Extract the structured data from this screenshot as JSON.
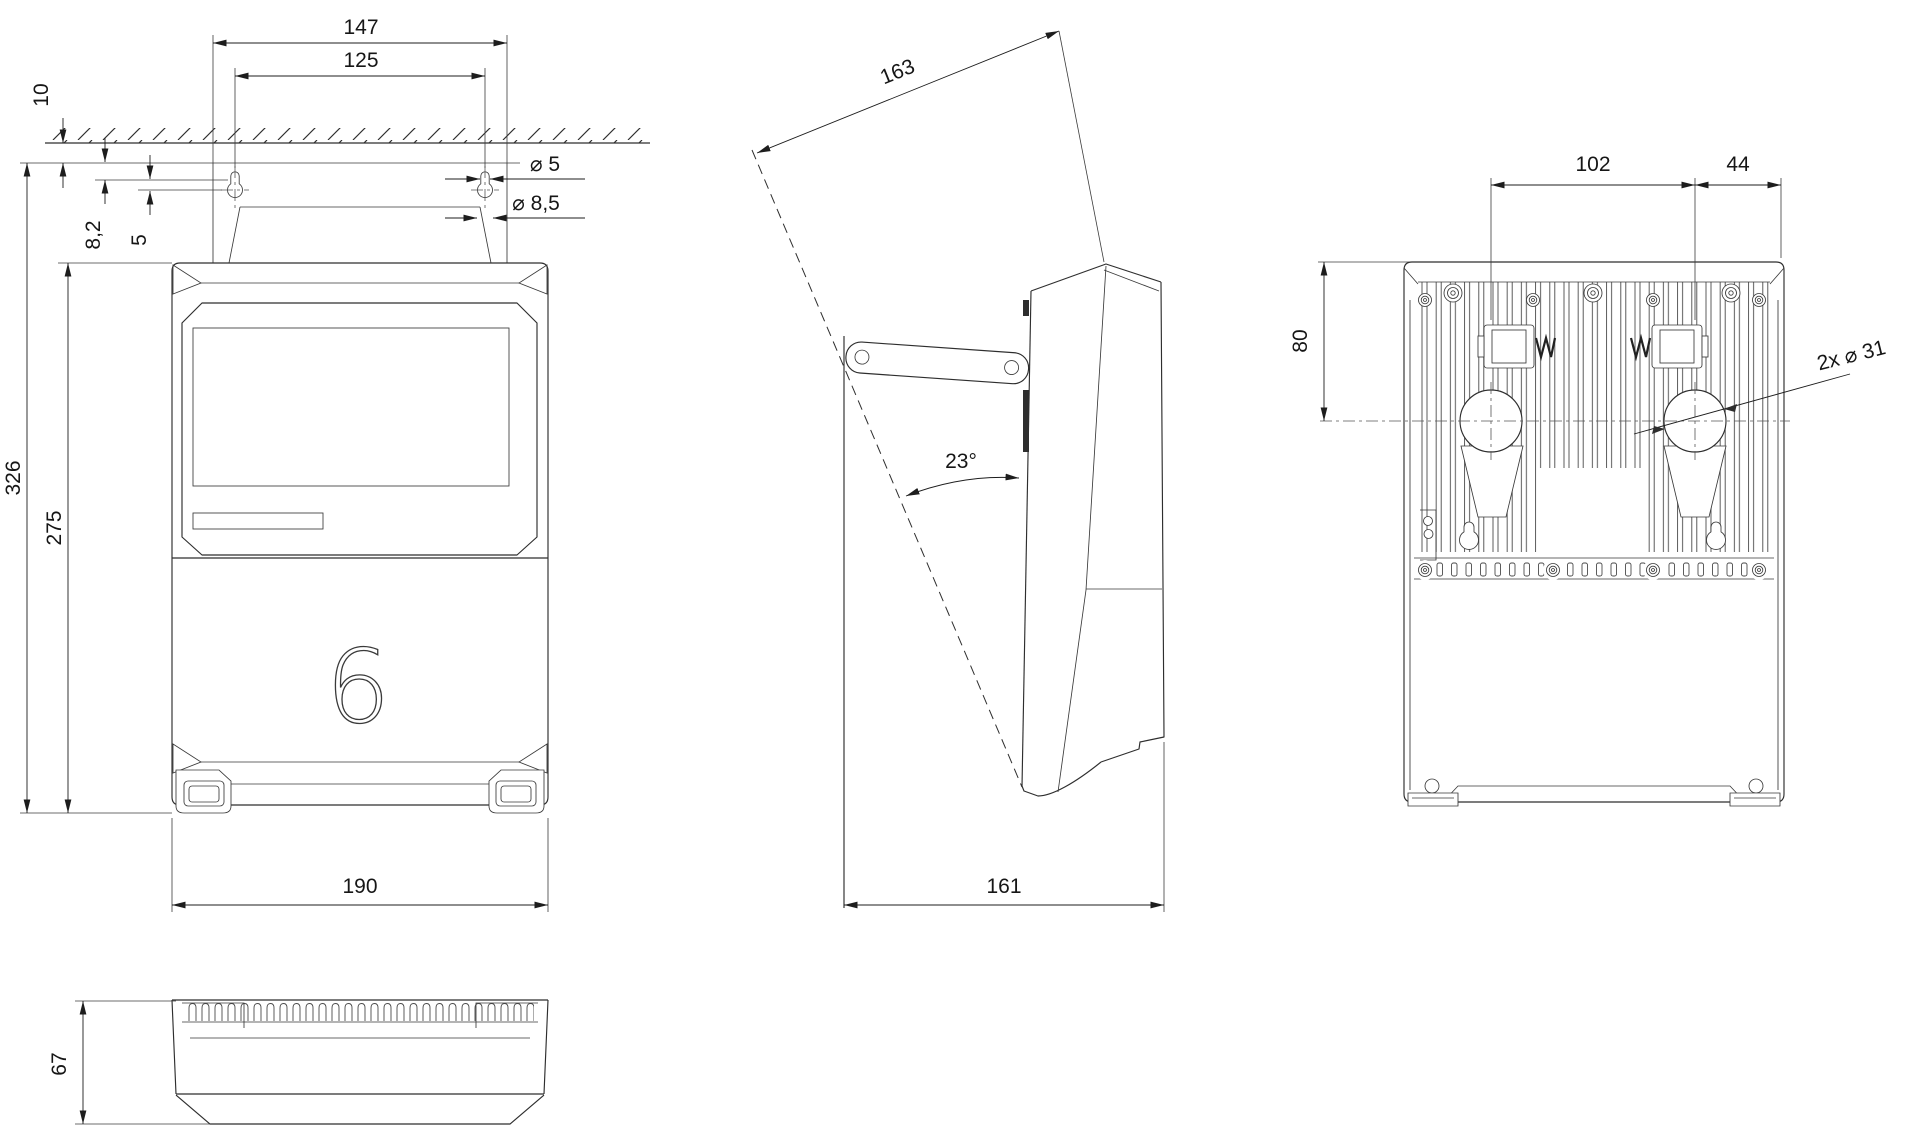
{
  "drawing": {
    "front": {
      "plate_width": "147",
      "hole_spacing": "125",
      "wall_gap": "10",
      "slot_top_offset": "8,2",
      "slot_length": "5",
      "slot_dia": "⌀ 5",
      "hole_dia": "⌀ 8,5",
      "overall_height": "326",
      "body_height": "275",
      "body_width": "190",
      "logo": "6"
    },
    "side": {
      "tilt_length": "163",
      "tilt_angle": "23°",
      "depth": "161"
    },
    "rear": {
      "hook_spacing": "102",
      "hook_to_edge": "44",
      "entry_offset": "80",
      "entry_dia": "2x ⌀ 31"
    },
    "bottom": {
      "depth": "67"
    }
  }
}
